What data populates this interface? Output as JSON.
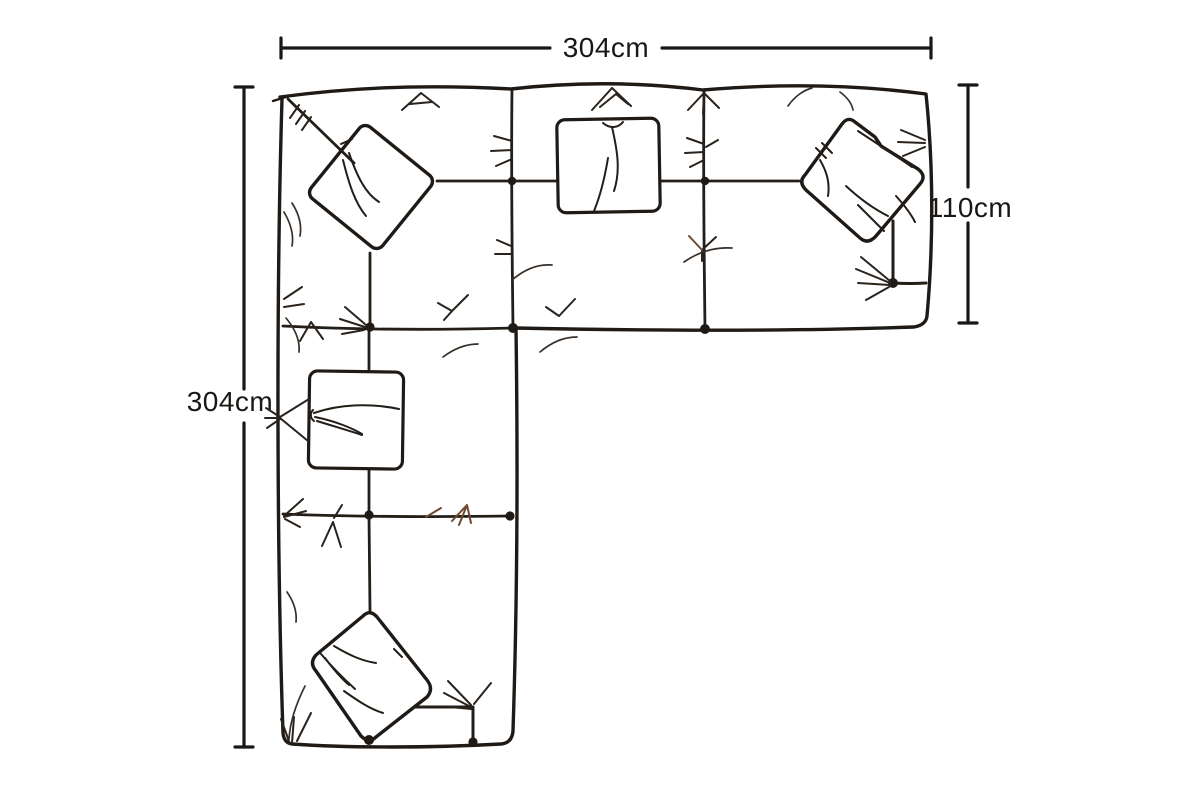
{
  "page": {
    "background_color": "#ffffff"
  },
  "diagram": {
    "subject": "corner-sofa-top-view",
    "style": "hand-drawn line illustration with scatter cushions",
    "ink_color": "#1f1a15",
    "wrinkle_color": "#38302a",
    "accent_brown": "#6d4a31",
    "dimensions": {
      "top_width": {
        "label": "304cm",
        "orientation": "horizontal"
      },
      "left_length": {
        "label": "304cm",
        "orientation": "vertical"
      },
      "right_depth": {
        "label": "110cm",
        "orientation": "vertical"
      }
    }
  }
}
